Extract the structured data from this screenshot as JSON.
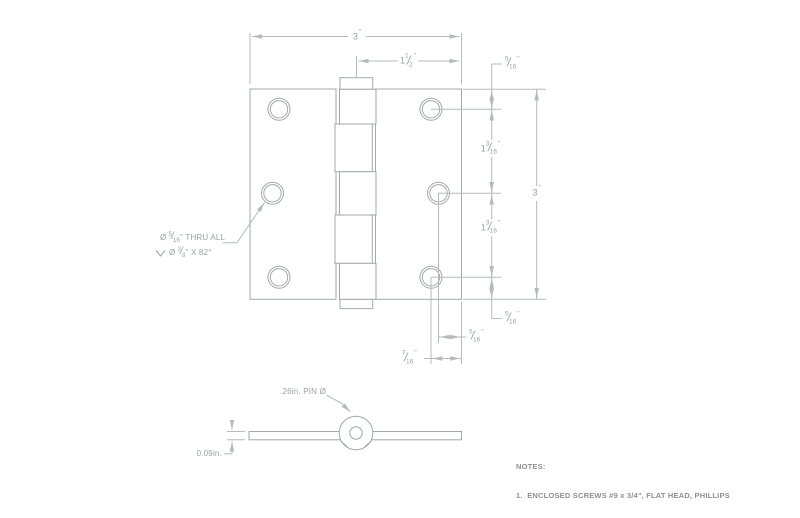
{
  "title": "Hinge engineering drawing",
  "symbols": {
    "frac_slash": "/",
    "inch": "\"",
    "diameter": "Ø"
  },
  "dims": {
    "top_overall": {
      "whole": "3",
      "unit": "\""
    },
    "top_half": {
      "whole": "1",
      "num": "1",
      "den": "2",
      "unit": "\""
    },
    "right_top_margin": {
      "num": "5",
      "den": "16",
      "unit": "\""
    },
    "right_gap_upper": {
      "whole": "1",
      "num": "3",
      "den": "16",
      "unit": "\""
    },
    "right_gap_lower": {
      "whole": "1",
      "num": "3",
      "den": "16",
      "unit": "\""
    },
    "right_overall": {
      "whole": "3",
      "unit": "\""
    },
    "right_bottom_margin": {
      "num": "5",
      "den": "16",
      "unit": "\""
    },
    "bottom_inner": {
      "num": "5",
      "den": "16",
      "unit": "\""
    },
    "bottom_outer": {
      "num": "7",
      "den": "16",
      "unit": "\""
    }
  },
  "callout": {
    "line1_prefix": "Ø ",
    "line1_num": "5",
    "line1_den": "16",
    "line1_suffix": "\" THRU ALL",
    "line2_prefix": "Ø ",
    "line2_num": "3",
    "line2_den": "8",
    "line2_suffix": "\" X 82°"
  },
  "section_view": {
    "pin_label": ".26in. PIN Ø",
    "thickness_label": "0.09in."
  },
  "notes": {
    "title": "NOTES:",
    "items": [
      {
        "text": "1.  ENCLOSED SCREWS #9 x 3/4\", FLAT HEAD, PHILLIPS"
      }
    ]
  },
  "colors": {
    "background": "#ffffff",
    "part_line": "#a3a8ac",
    "dimension_line": "#b6babd",
    "dimension_text": "#9aa0a4",
    "notes_text": "#8b9093"
  }
}
